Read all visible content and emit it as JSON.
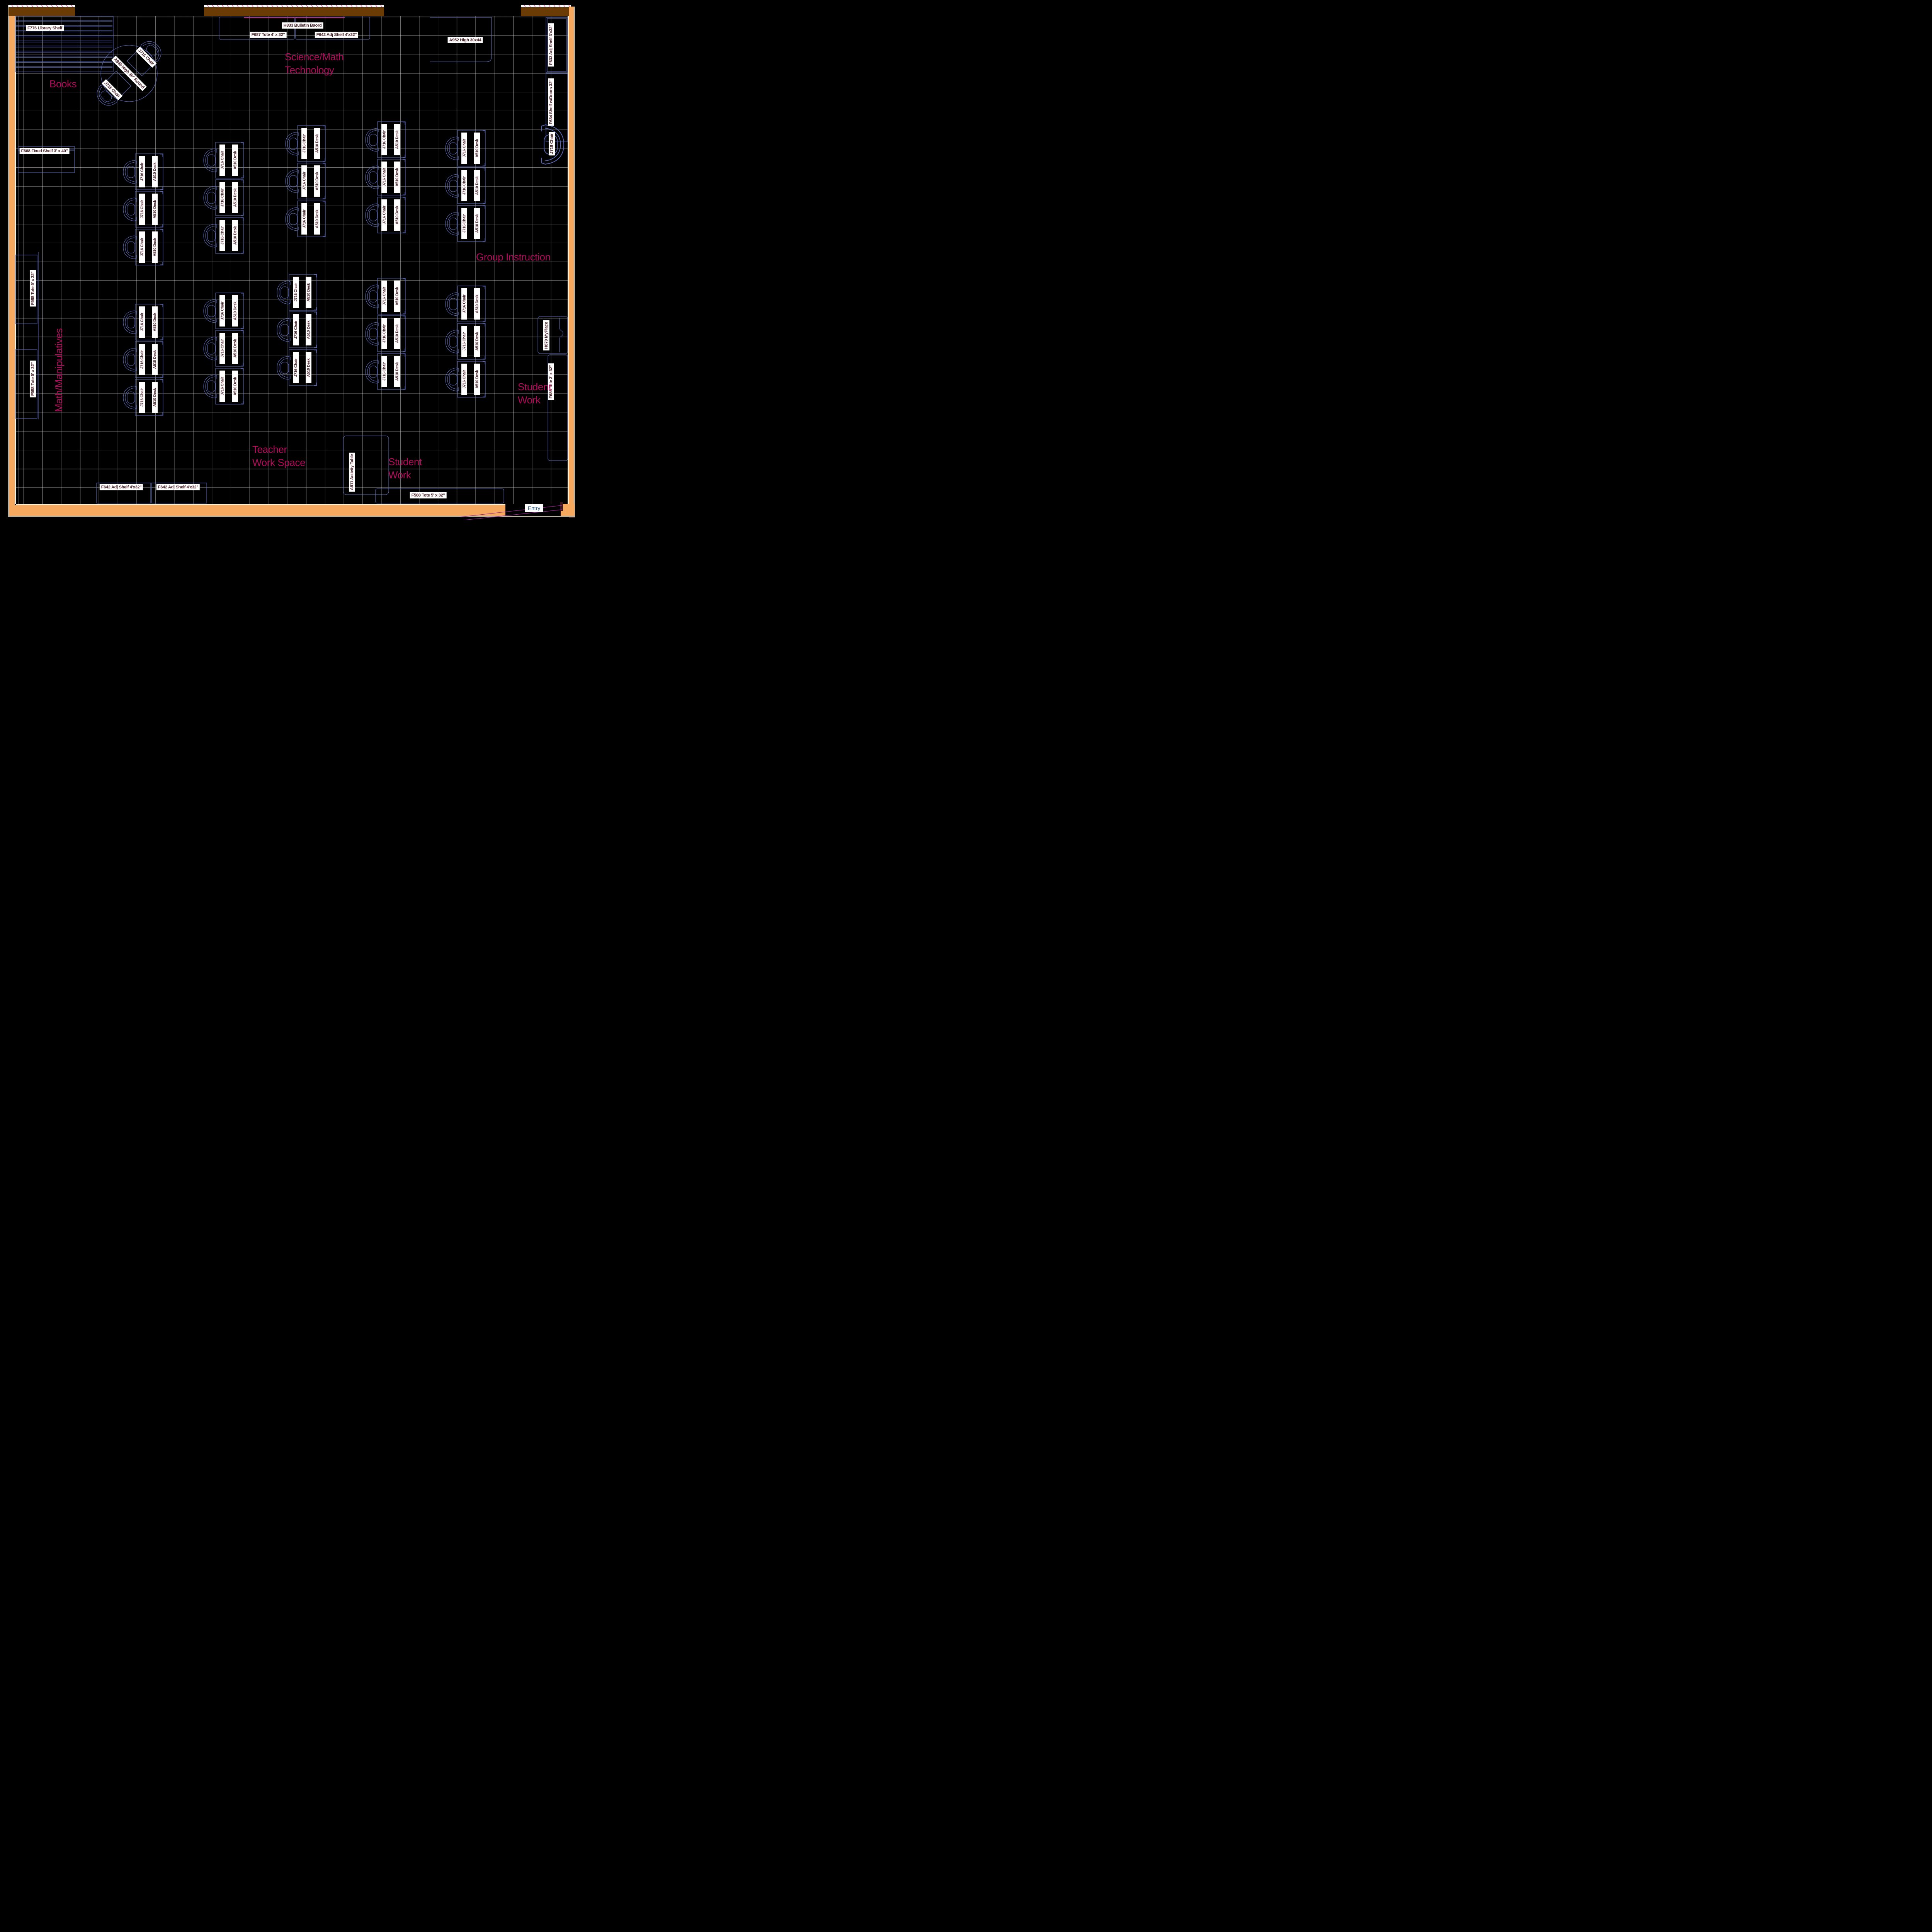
{
  "drawing": {
    "type": "classroom-floor-plan",
    "accent_colors": {
      "zone_text": "#b1095a",
      "furniture_outline": "#5a68b0",
      "label_text": "#4a2128",
      "wall_orange": "#f7a85f",
      "wall_brown": "#6b3b06",
      "bulletin_line": "#d6318c",
      "door_swing": "#92278f",
      "entry_text": "#1f4e79"
    }
  },
  "zones": {
    "books": "Books",
    "science": "Science/Math\nTechnology",
    "group_instruction": "Group Instruction",
    "math_manipulatives": "Math/Manipulatives",
    "teacher_work_space": "Teacher\nWork Space",
    "student_work_bottom": "Student\nWork",
    "student_work_right": "Student\nWork"
  },
  "labels": {
    "f776": "F776 Library Shelf",
    "h833": "H833 Bulletin Baord",
    "f687": "F687 Tote 4' x 32\"",
    "f642_top": "F642 Adj Shelf 4'x32\"",
    "a952": "A952 High 30x44",
    "f633": "F633 Adj Shelf 3'x32\"",
    "f634": "F634 Shelf w/Doors 32\"",
    "j718": "J718 Chair",
    "f668": "F668 Fixed Shelf 3' x 40\"",
    "f588_left1": "F588 Tote 5' x 32\"",
    "f588_left2": "F588 Tote 5' x 32\"",
    "h870": "H870 MyPlace",
    "f686": "F686 Tote 3' x 32\"",
    "f642_bottom1": "F642 Adj Shelf 4'x32\"",
    "f642_bottom2": "F642 Adj Shelf 4'x32\"",
    "a811": "A811 Activity Table",
    "f588_bottom": "F588 Tote 5' x 32\"",
    "a940": "A940 High 36\" Round",
    "j716_ne": "J716 Chair",
    "j716_sw": "J716 Chair"
  },
  "desk_unit": {
    "chair_label": "J716 Chair",
    "desk_label": "A510 Desk",
    "count": 30
  },
  "entry": {
    "label": "Entry"
  }
}
